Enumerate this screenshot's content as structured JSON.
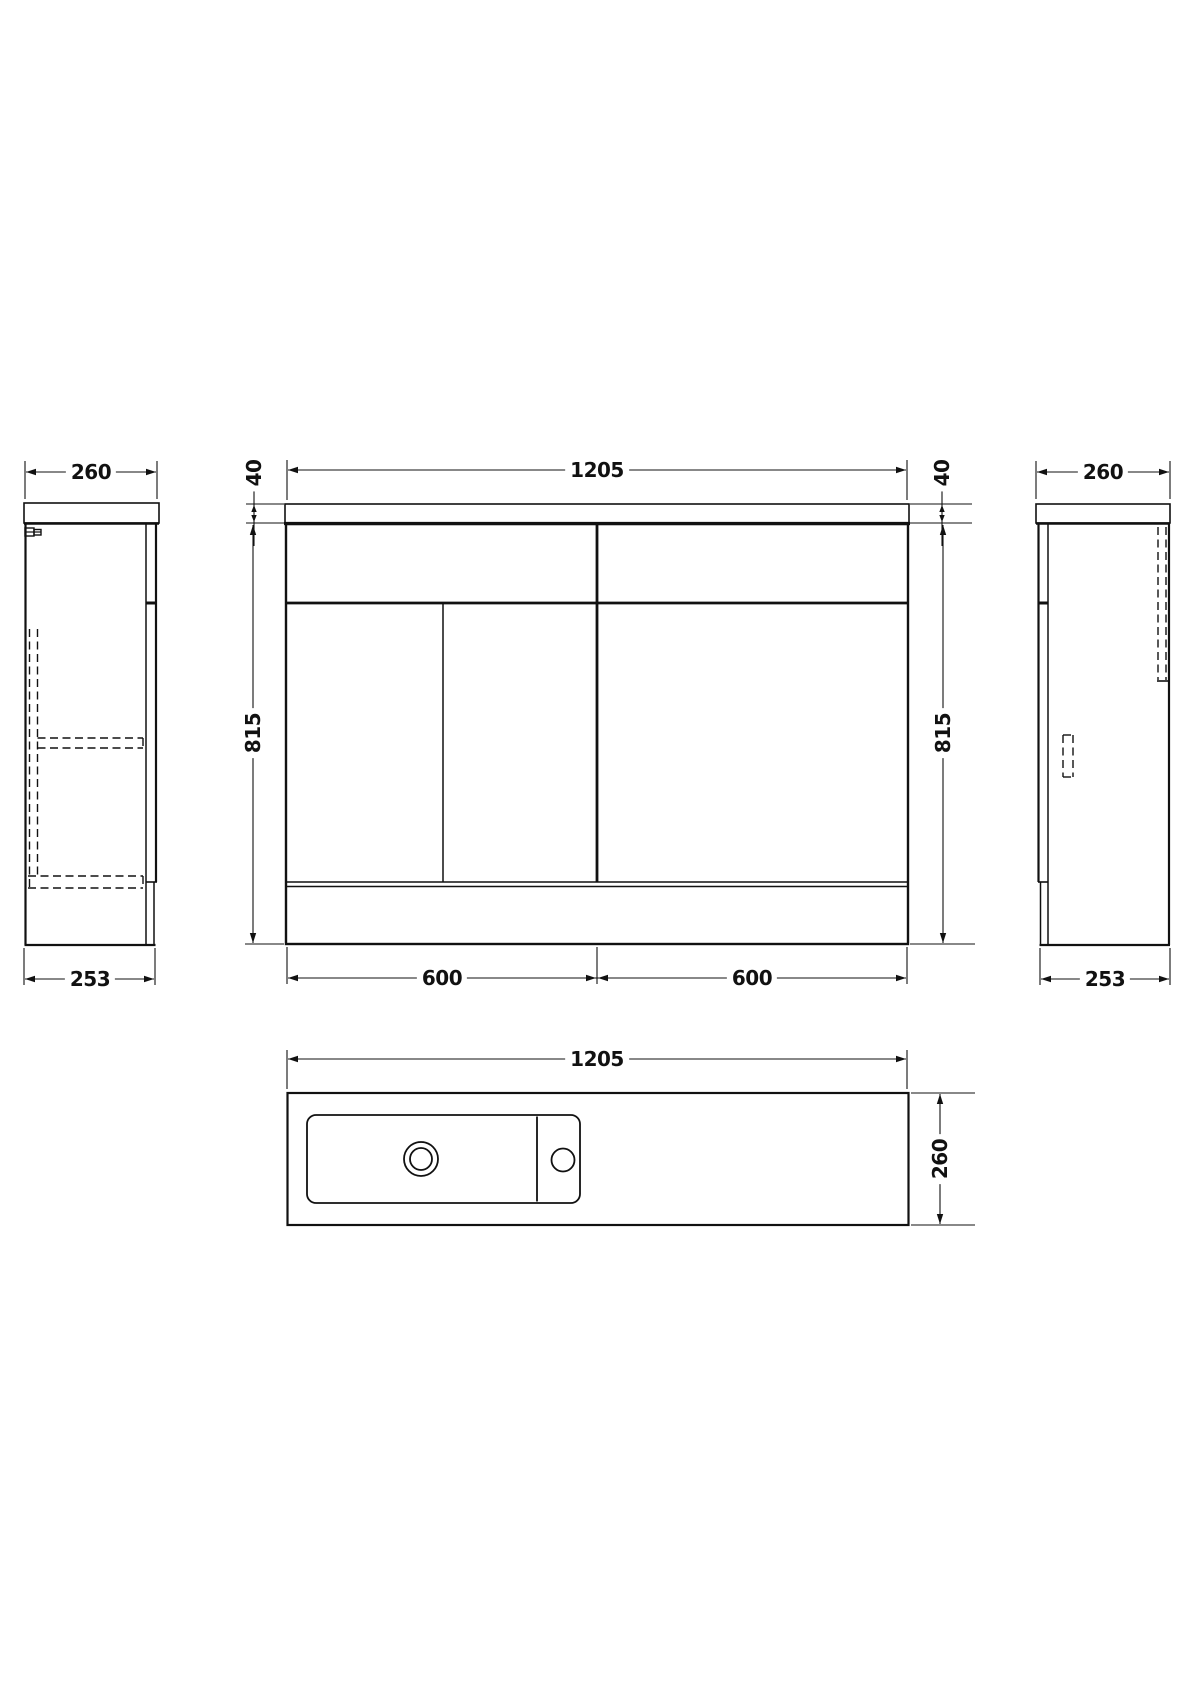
{
  "diagram": {
    "type": "technical-drawing",
    "subject": "vanity-unit-orthographic-dimension-drawing",
    "background": "#ffffff",
    "line_color": "#111111",
    "views": {
      "front": {
        "name": "front elevation",
        "width": "1205",
        "worktop_thickness_left": "40",
        "worktop_thickness_right": "40",
        "height_left": "815",
        "height_right": "815",
        "left_unit_width": "600",
        "right_unit_width": "600"
      },
      "left_side": {
        "name": "left side elevation",
        "depth_top": "260",
        "depth_bottom": "253"
      },
      "right_side": {
        "name": "right side elevation",
        "depth_top": "260",
        "depth_bottom": "253"
      },
      "plan": {
        "name": "plan view with basin",
        "width": "1205",
        "depth": "260"
      }
    }
  }
}
